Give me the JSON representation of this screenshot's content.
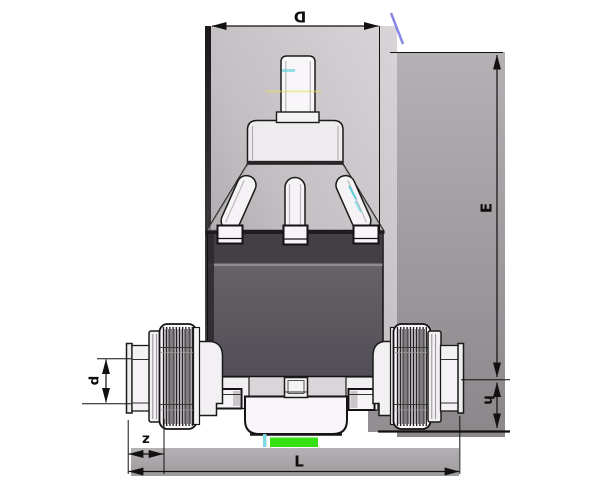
{
  "drawing": {
    "title": "diaphragm-valve-dimension-drawing",
    "dimension_labels": {
      "D": "D",
      "E": "E",
      "d": "d",
      "h": "h",
      "z": "z",
      "L": "L"
    }
  },
  "colors": {
    "line": "#1a1a1a",
    "panel_light": "#d6d2d6",
    "panel_dark": "#8e8a8e",
    "body_dark": "#434043",
    "body_mid": "#66626a",
    "artifact_green": "#35e112",
    "artifact_cyan": "#7fd9e2",
    "artifact_blue": "#6b6bdf"
  }
}
